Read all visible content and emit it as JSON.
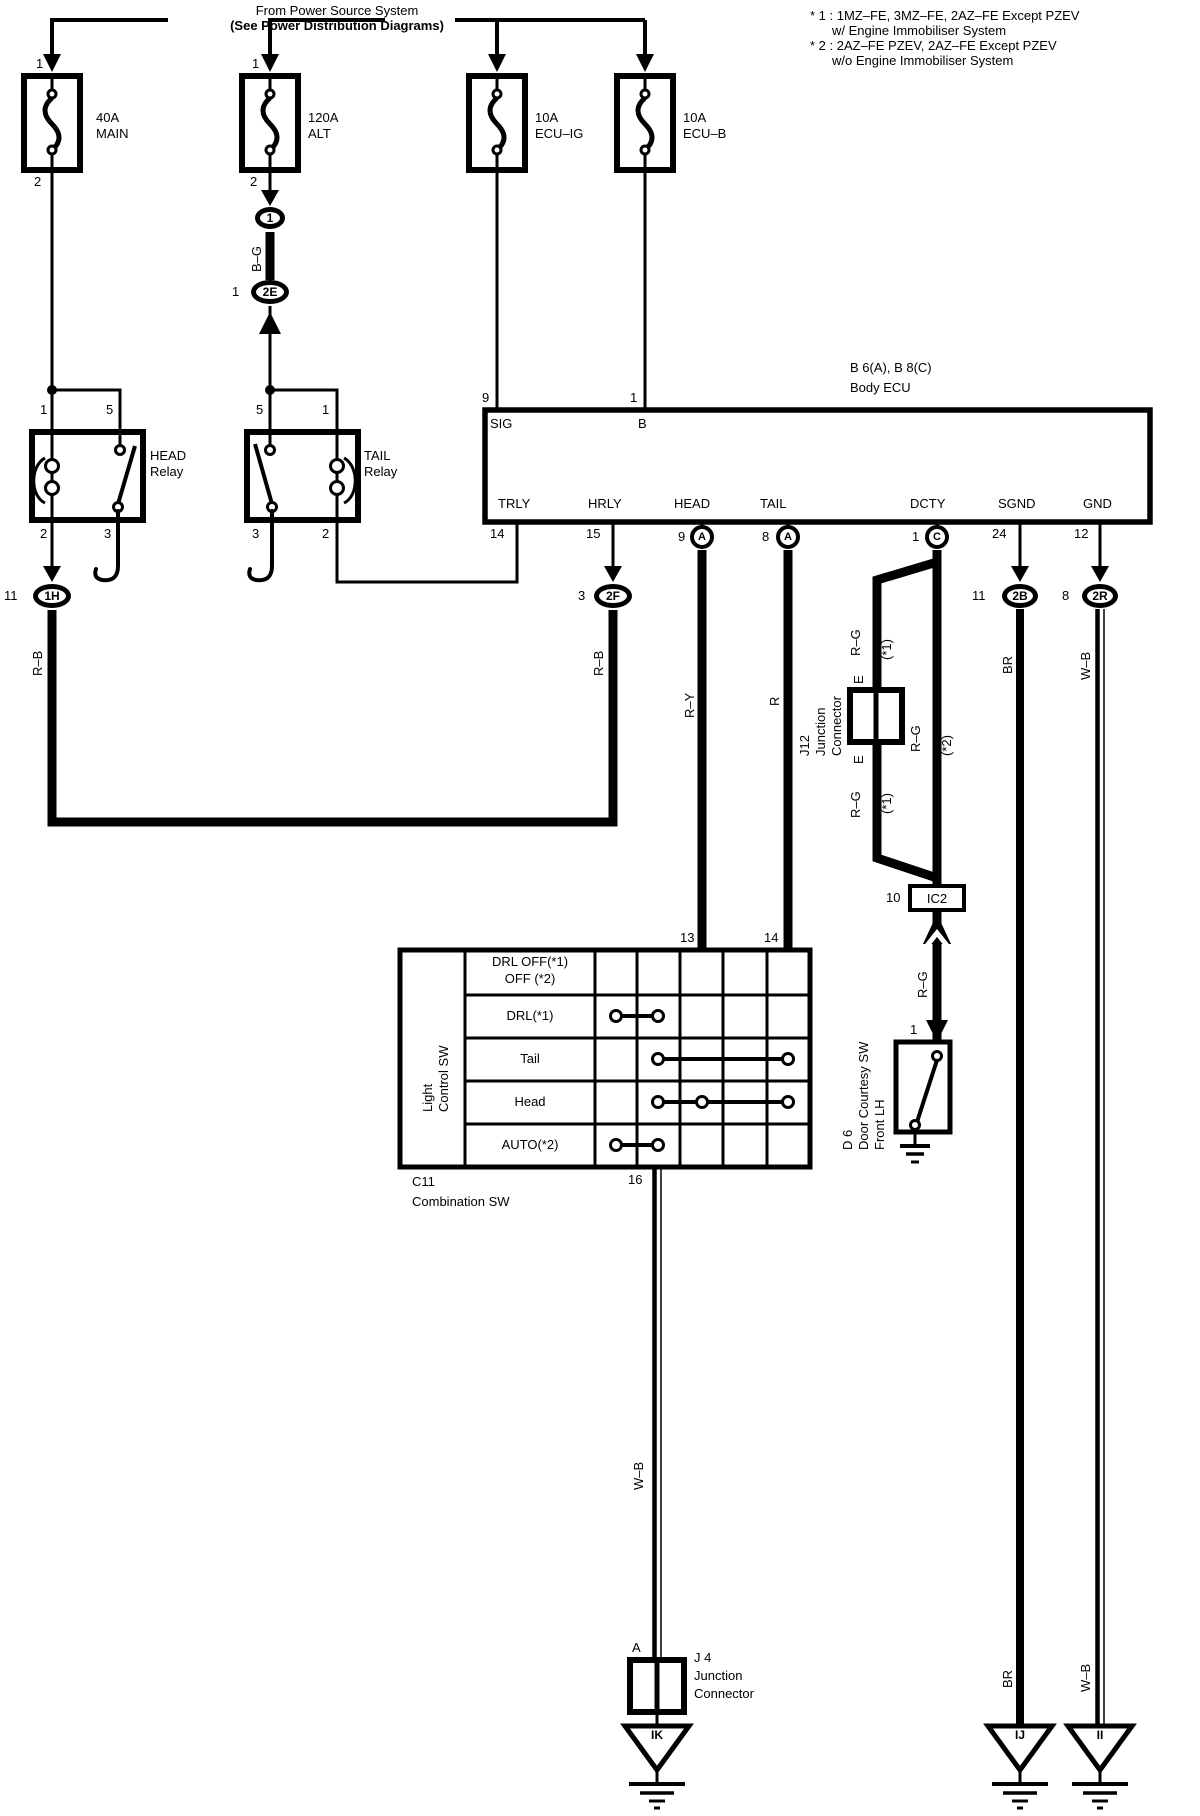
{
  "colors": {
    "ink": "#000000",
    "background": "#ffffff"
  },
  "header": {
    "line1": "From Power Source System",
    "line2": "(See Power Distribution Diagrams)"
  },
  "notes": {
    "n1a": "* 1 : 1MZ–FE, 3MZ–FE, 2AZ–FE Except PZEV",
    "n1b": "w/ Engine Immobiliser System",
    "n2a": "* 2 : 2AZ–FE PZEV, 2AZ–FE Except PZEV",
    "n2b": "w/o Engine Immobiliser System"
  },
  "fuses": {
    "main": {
      "pin_top": "1",
      "pin_bottom": "2",
      "rating": "40A",
      "name": "MAIN"
    },
    "alt": {
      "pin_top": "1",
      "pin_bottom": "2",
      "rating": "120A",
      "name": "ALT"
    },
    "ecu_ig": {
      "rating": "10A",
      "name": "ECU–IG"
    },
    "ecu_b": {
      "rating": "10A",
      "name": "ECU–B"
    }
  },
  "relays": {
    "head": {
      "line1": "HEAD",
      "line2": "Relay",
      "pin_tl": "1",
      "pin_tr": "5",
      "pin_bl": "2",
      "pin_br": "3"
    },
    "tail": {
      "line1": "TAIL",
      "line2": "Relay",
      "pin_tl": "5",
      "pin_tr": "1",
      "pin_bl": "3",
      "pin_br": "2"
    }
  },
  "ecu": {
    "code": "B 6(A), B 8(C)",
    "name": "Body ECU",
    "sig_num": "9",
    "sig": "SIG",
    "b_num": "1",
    "b": "B",
    "trly": "TRLY",
    "trly_num": "14",
    "hrly": "HRLY",
    "hrly_num": "15",
    "head": "HEAD",
    "head_num": "9",
    "head_conn": "A",
    "tail": "TAIL",
    "tail_num": "8",
    "tail_conn": "A",
    "dcty": "DCTY",
    "dcty_num": "1",
    "dcty_conn": "C",
    "sgnd": "SGND",
    "sgnd_num": "24",
    "gnd": "GND",
    "gnd_num": "12"
  },
  "connectors": {
    "c1": "1",
    "c2e": {
      "pin": "1",
      "label": "2E"
    },
    "c1h": {
      "pin": "11",
      "label": "1H"
    },
    "c2f": {
      "pin": "3",
      "label": "2F"
    },
    "c2b": {
      "pin": "11",
      "label": "2B"
    },
    "c2r": {
      "pin": "8",
      "label": "2R"
    },
    "ic2": {
      "pin": "10",
      "label": "IC2"
    },
    "j12": {
      "id": "J12",
      "line1": "Junction",
      "line2": "Connector",
      "pin_top": "E",
      "pin_bottom": "E"
    },
    "j4": {
      "id": "J 4",
      "line1": "Junction",
      "line2": "Connector",
      "pin": "A"
    }
  },
  "wires": {
    "bg": "B–G",
    "rb_left": "R–B",
    "rb_right": "R–B",
    "ry": "R–Y",
    "r": "R",
    "rg": "R–G",
    "note1": "(*1)",
    "note2": "(*2)",
    "br": "BR",
    "wb": "W–B"
  },
  "combo_sw": {
    "pin13": "13",
    "pin14": "14",
    "pin16": "16",
    "side1": "Light",
    "side2": "Control SW",
    "id": "C11",
    "name": "Combination SW",
    "rows": [
      {
        "line1": "DRL OFF(*1)",
        "line2": "OFF  (*2)"
      },
      {
        "line1": "DRL(*1)"
      },
      {
        "line1": "Tail"
      },
      {
        "line1": "Head"
      },
      {
        "line1": "AUTO(*2)"
      }
    ]
  },
  "door_sw": {
    "pin": "1",
    "id": "D 6",
    "name": "Door Courtesy SW",
    "loc": "Front LH"
  },
  "grounds": {
    "ik": "IK",
    "ij": "IJ",
    "ii": "II"
  }
}
